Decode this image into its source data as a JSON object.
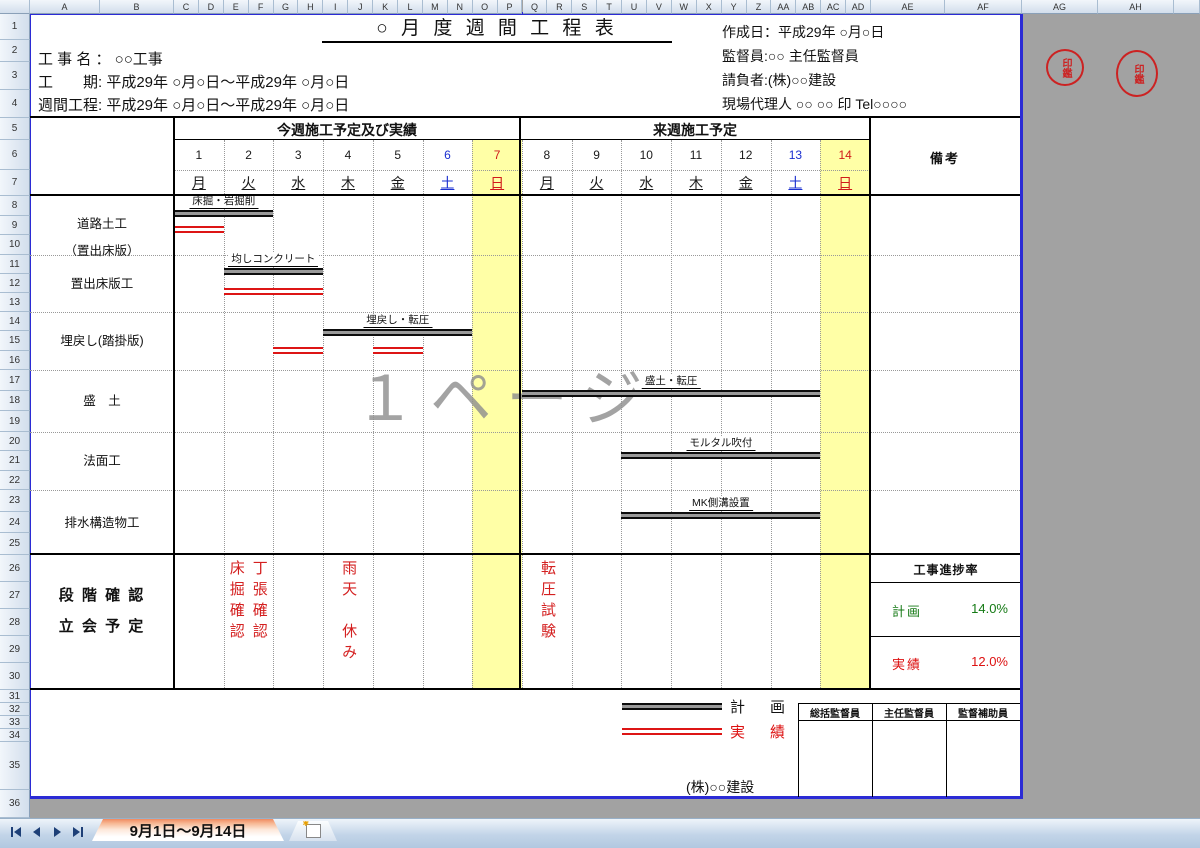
{
  "chrome": {
    "column_headers": [
      "A",
      "B",
      "C",
      "D",
      "E",
      "F",
      "G",
      "H",
      "I",
      "J",
      "K",
      "L",
      "M",
      "N",
      "O",
      "P",
      "Q",
      "R",
      "S",
      "T",
      "U",
      "V",
      "W",
      "X",
      "Y",
      "Z",
      "AA",
      "AB",
      "AC",
      "AD",
      "AE",
      "AF",
      "AG",
      "AH"
    ],
    "row_headers": [
      "1",
      "2",
      "3",
      "4",
      "5",
      "6",
      "7",
      "8",
      "9",
      "10",
      "11",
      "12",
      "13",
      "14",
      "15",
      "16",
      "17",
      "18",
      "19",
      "20",
      "21",
      "22",
      "23",
      "24",
      "25",
      "26",
      "27",
      "28",
      "29",
      "30",
      "31",
      "32",
      "33",
      "34",
      "35",
      "36"
    ],
    "tab_label": "9月1日～9月14日"
  },
  "header": {
    "title": "○ 月 度 週 間 工 程 表",
    "left_lines": [
      "工 事 名 ： ○○工事",
      "工　　期: 平成29年 ○月○日～平成29年 ○月○日",
      "週間工程: 平成29年 ○月○日～平成29年 ○月○日"
    ],
    "right_lines": [
      "作成日：平成29年 ○月○日",
      "監督員:○○ 主任監督員",
      "請負者:(株)○○建設",
      "現場代理人 ○○ ○○ 印 Tel○○○○"
    ],
    "stamps": [
      "印鑑",
      "印鑑"
    ]
  },
  "schedule": {
    "week1_header": "今週施工予定及び実績",
    "week2_header": "来週施工予定",
    "remarks_header": "備考",
    "days": [
      {
        "num": "1",
        "dow": "月",
        "color": "#1a1a1a",
        "highlight": false
      },
      {
        "num": "2",
        "dow": "火",
        "color": "#1a1a1a",
        "highlight": false
      },
      {
        "num": "3",
        "dow": "水",
        "color": "#1a1a1a",
        "highlight": false
      },
      {
        "num": "4",
        "dow": "木",
        "color": "#1a1a1a",
        "highlight": false
      },
      {
        "num": "5",
        "dow": "金",
        "color": "#1a1a1a",
        "highlight": false
      },
      {
        "num": "6",
        "dow": "土",
        "color": "#1a2fd0",
        "highlight": false
      },
      {
        "num": "7",
        "dow": "日",
        "color": "#d01a1a",
        "highlight": true
      },
      {
        "num": "8",
        "dow": "月",
        "color": "#1a1a1a",
        "highlight": false
      },
      {
        "num": "9",
        "dow": "火",
        "color": "#1a1a1a",
        "highlight": false
      },
      {
        "num": "10",
        "dow": "水",
        "color": "#1a1a1a",
        "highlight": false
      },
      {
        "num": "11",
        "dow": "木",
        "color": "#1a1a1a",
        "highlight": false
      },
      {
        "num": "12",
        "dow": "金",
        "color": "#1a1a1a",
        "highlight": false
      },
      {
        "num": "13",
        "dow": "土",
        "color": "#1a2fd0",
        "highlight": false
      },
      {
        "num": "14",
        "dow": "日",
        "color": "#d01a1a",
        "highlight": true
      }
    ],
    "work_rows": [
      {
        "label_lines": [
          "道路土工",
          "（置出床版）"
        ],
        "bar_label": "床掘・岩掘削"
      },
      {
        "label_lines": [
          "置出床版工"
        ],
        "bar_label": "均しコンクリート"
      },
      {
        "label_lines": [
          "埋戻し(踏掛版)"
        ],
        "bar_label": "埋戻し・転圧"
      },
      {
        "label_lines": [
          "盛　土"
        ],
        "bar_label": "盛土・転圧"
      },
      {
        "label_lines": [
          "法面工"
        ],
        "bar_label": "モルタル吹付"
      },
      {
        "label_lines": [
          "排水構造物工"
        ],
        "bar_label": "MK側溝設置"
      }
    ],
    "bars": [
      {
        "row": 1,
        "kind": "plan",
        "start_day": 1,
        "end_day": 2
      },
      {
        "row": 1,
        "kind": "actual",
        "start_day": 1,
        "end_day": 1
      },
      {
        "row": 2,
        "kind": "plan",
        "start_day": 2,
        "end_day": 3
      },
      {
        "row": 2,
        "kind": "actual",
        "start_day": 2,
        "end_day": 3
      },
      {
        "row": 3,
        "kind": "plan",
        "start_day": 4,
        "end_day": 6
      },
      {
        "row": 3,
        "kind": "actual",
        "start_day": 3,
        "end_day": 3
      },
      {
        "row": 3,
        "kind": "actual",
        "start_day": 5,
        "end_day": 5
      },
      {
        "row": 4,
        "kind": "plan",
        "start_day": 8,
        "end_day": 13
      },
      {
        "row": 5,
        "kind": "plan",
        "start_day": 10,
        "end_day": 13
      },
      {
        "row": 6,
        "kind": "plan",
        "start_day": 10,
        "end_day": 13
      }
    ]
  },
  "confirm": {
    "label_lines": [
      "段 階 確 認",
      "立 会 予 定"
    ],
    "notes": [
      {
        "text": "床掘確認",
        "day": 2,
        "slot": 0
      },
      {
        "text": "丁張確認",
        "day": 2,
        "slot": 1
      },
      {
        "text": "雨天　休み",
        "day": 4,
        "slot": -1
      },
      {
        "text": "転圧試験",
        "day": 8,
        "slot": -1
      }
    ]
  },
  "progress": {
    "title": "工事進捗率",
    "plan_label": "計画",
    "plan_value": "14.0%",
    "actual_label": "実績",
    "actual_value": "12.0%"
  },
  "legend": {
    "plan_label": "計　画",
    "actual_label": "実　績",
    "company": "(株)○○建設"
  },
  "supervisors": [
    "総括監督員",
    "主任監督員",
    "監督補助員"
  ],
  "watermark": "１ページ",
  "colors": {
    "holiday_bg": "#ffffa6",
    "plan_bar": "#0d0d0d",
    "actual_bar": "#dd1515",
    "saturday_text": "#1a2fd0",
    "sunday_text": "#d01a1a",
    "plan_green": "#157a15",
    "actual_red": "#dd1111",
    "stamp_red": "#cc2222",
    "page_border_blue": "#2b2bd5"
  }
}
